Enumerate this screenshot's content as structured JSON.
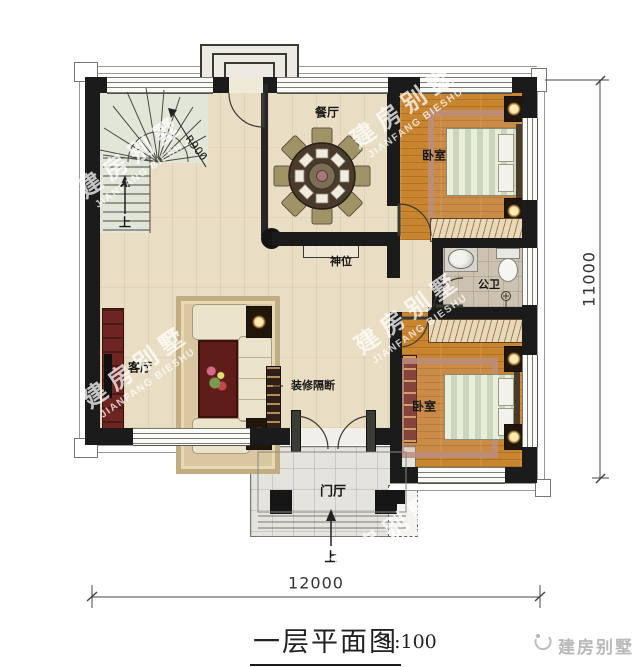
{
  "watermark": {
    "cn": "建房别墅",
    "en": "JIANFANG BIESHU"
  },
  "rooms": {
    "dining": "餐厅",
    "living": "客厅",
    "bedroom_top": "卧室",
    "bedroom_bottom": "卧室",
    "bathroom": "公卫",
    "foyer": "门厅",
    "shrine": "神位",
    "partition_note": "装修隔断"
  },
  "stairs": {
    "up": "上",
    "radius": "R900"
  },
  "entry": {
    "up": "上"
  },
  "dims": {
    "width": "12000",
    "height": "11000"
  },
  "titleblock": {
    "title": "一层平面图",
    "scale": "1:100",
    "brand": "建房别墅"
  },
  "colors": {
    "wall": "#1b1b1b",
    "floor_main": "#e9dec4",
    "floor_bedroom": "#c8842f",
    "floor_bath": "#cdc2b0",
    "floor_porch": "#e4e3dd",
    "furniture_red": "#6e2420"
  }
}
